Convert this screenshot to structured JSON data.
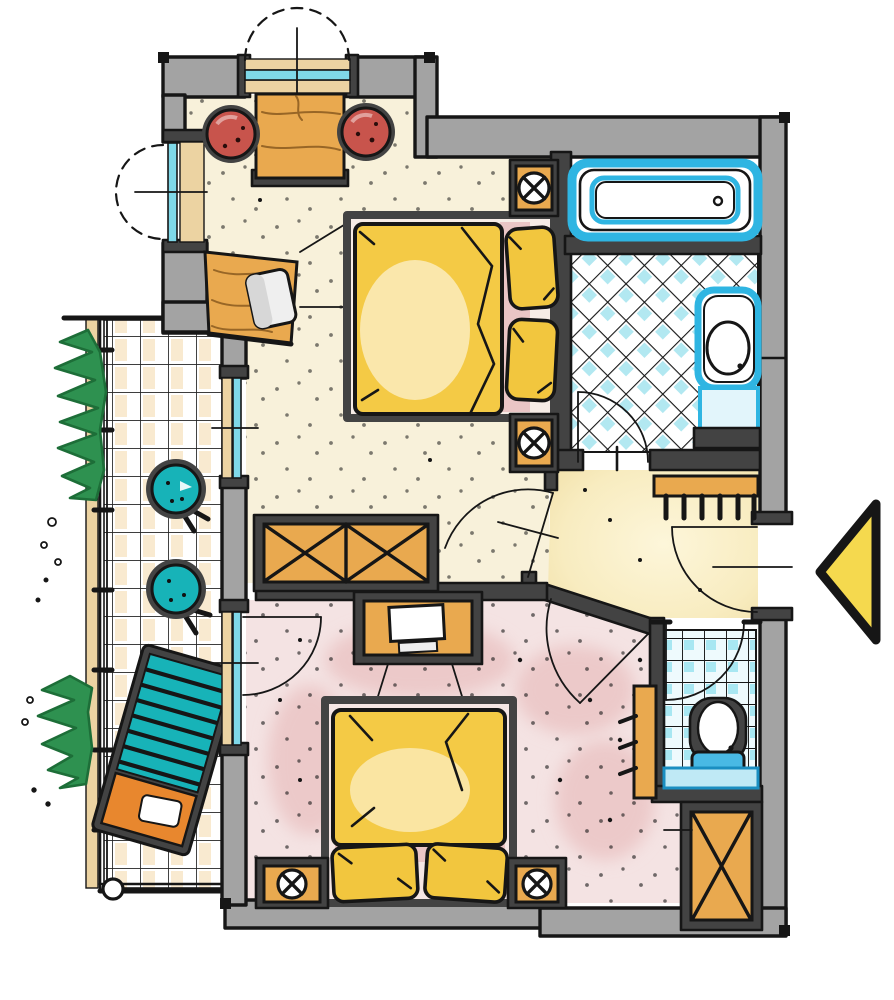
{
  "title": "Hand-drawn floor plan of a two-room suite with bathroom, WC and balcony",
  "palette": {
    "ink": "#161616",
    "wallFill": "#a3a3a3",
    "wallDark": "#434343",
    "floorBedroom1": "#f8f1da",
    "floorBedroom2": "#f4e3e3",
    "floorHall": "#f8ecc0",
    "pinkPatch": "#ecc9c9",
    "tileCyan": "#7fd8e8",
    "sanitaryCyan": "#2fb5e2",
    "wood": "#e9a94f",
    "woodGrain": "#8a5a1f",
    "redChair": "#c8544c",
    "teal": "#17b3b8",
    "duvet": "#f4ca45",
    "pillow": "#f2c63e",
    "sheetPink": "#eac5c5",
    "arrowYellow": "#f5d94e",
    "plantGreen": "#2e9150",
    "plantDark": "#1d6e38",
    "balconyTan": "#ecd3a2",
    "loungerOrange": "#e8872e"
  },
  "legend": {
    "rooms": [
      {
        "name": "bedroom-top",
        "floor": "cream stippled"
      },
      {
        "name": "bathroom",
        "floor": "cyan diamond tiles"
      },
      {
        "name": "hall",
        "floor": "pale yellow"
      },
      {
        "name": "bedroom-bottom",
        "floor": "pink stippled"
      },
      {
        "name": "wc",
        "floor": "cyan square tiles"
      },
      {
        "name": "balcony",
        "floor": "tile grid"
      }
    ],
    "furniture": [
      "double-bed-1",
      "double-bed-2",
      "nightstands-with-lamps",
      "desk-with-two-stools",
      "corner-vanity-with-stool",
      "wardrobe-x-front-1",
      "wardrobe-x-front-2",
      "tv-stand",
      "bathtub",
      "washbasin",
      "toilet",
      "coat-rack",
      "towel-hooks",
      "garden-chairs",
      "sun-lounger",
      "plants",
      "entrance-arrow"
    ],
    "entrance": {
      "marker": "yellow triangle arrow",
      "direction": "points left into entry door"
    }
  }
}
